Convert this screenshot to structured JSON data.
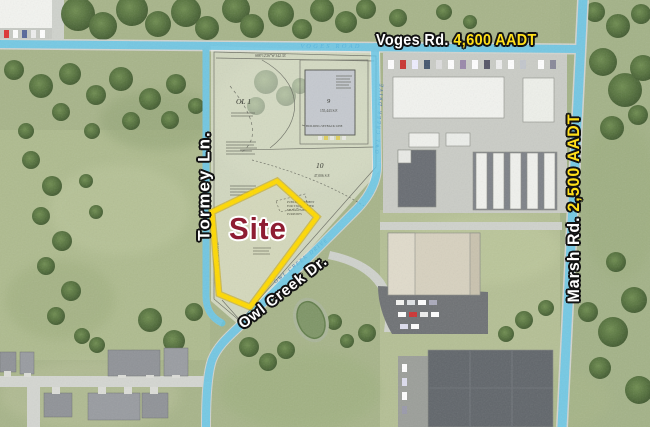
{
  "colors": {
    "highlight_blue": "#5cc5e9",
    "site_yellow": "#ffd900",
    "aadt_yellow": "#ffdf1a",
    "label_white": "#ffffff",
    "outline_black": "#121212",
    "site_red": "#8e1d32"
  },
  "labels": {
    "voges": {
      "road": "Voges Rd.",
      "aadt": "4,600 AADT"
    },
    "marsh": {
      "road": "Marsh Rd.",
      "aadt": "2,500 AADT"
    },
    "tormey": {
      "road": "Tormey Ln."
    },
    "owl_creek": {
      "road": "Owl Creek Dr."
    },
    "site": "Site"
  },
  "plat": {
    "voges_road": "VOGES ROAD",
    "owl_creek_drive_upper": "OWL CREEK DRIVE",
    "owl_creek_drive_lower": "OWL CREEK DRIVE",
    "tormey_lane": "TORMEY LANE",
    "bearing": "S88°12'26\"W  342.33'",
    "outlot": "OL 1",
    "lot9": {
      "number": "9",
      "area": "155,443 S.F."
    },
    "lot10": {
      "number": "10",
      "area": "47,006 S.F."
    },
    "lot11": {
      "number": "11"
    },
    "setback_note": "BUILDING SETBACK LINE",
    "easement_note_lines": [
      "PUBLIC EASEMENT",
      "FOR STORMWATER",
      "MANAGEMENT",
      "PURPOSES"
    ]
  }
}
